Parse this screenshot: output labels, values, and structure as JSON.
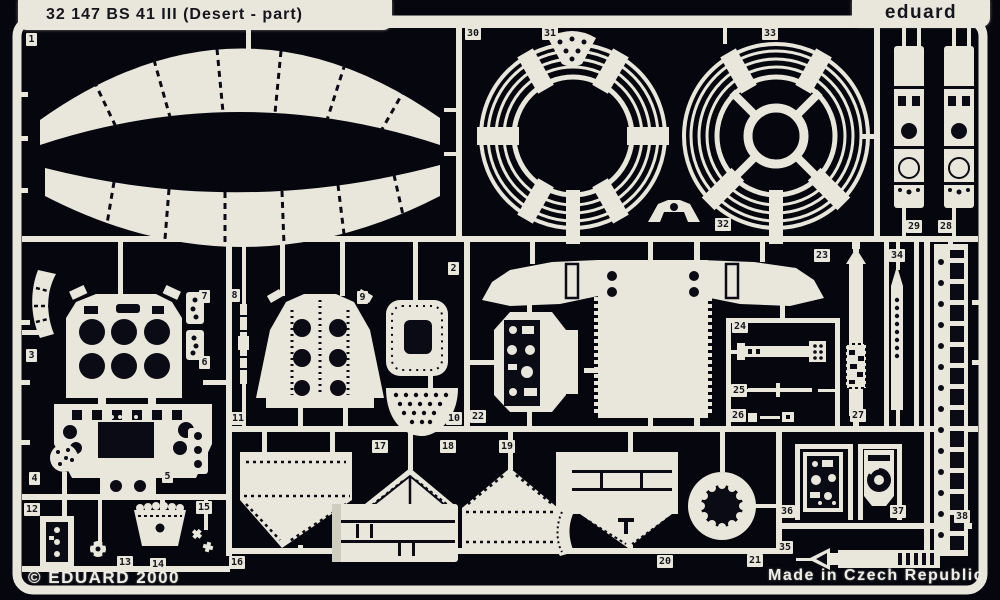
{
  "colors": {
    "background": "#06060e",
    "ink": "#0b0b16",
    "metal": "#e9e7dc",
    "metal_dim": "#cfccc0",
    "text_dark": "#15151d",
    "text_light": "#eeede6"
  },
  "header": {
    "title": "32 147 BS 41 III (Desert - part)",
    "brand": "eduard"
  },
  "footer": {
    "copyright": "© EDUARD 2000",
    "origin": "Made in Czech Republic"
  },
  "parts": [
    {
      "num": "1",
      "x": 26,
      "y": 33
    },
    {
      "num": "2",
      "x": 448,
      "y": 262
    },
    {
      "num": "3",
      "x": 26,
      "y": 349
    },
    {
      "num": "4",
      "x": 29,
      "y": 472
    },
    {
      "num": "5",
      "x": 162,
      "y": 470
    },
    {
      "num": "6",
      "x": 199,
      "y": 356
    },
    {
      "num": "7",
      "x": 199,
      "y": 290
    },
    {
      "num": "8",
      "x": 229,
      "y": 289
    },
    {
      "num": "9",
      "x": 357,
      "y": 291
    },
    {
      "num": "10",
      "x": 446,
      "y": 412
    },
    {
      "num": "11",
      "x": 230,
      "y": 412
    },
    {
      "num": "12",
      "x": 24,
      "y": 503
    },
    {
      "num": "13",
      "x": 117,
      "y": 556
    },
    {
      "num": "14",
      "x": 150,
      "y": 558
    },
    {
      "num": "15",
      "x": 196,
      "y": 501
    },
    {
      "num": "16",
      "x": 229,
      "y": 556
    },
    {
      "num": "17",
      "x": 372,
      "y": 440
    },
    {
      "num": "18",
      "x": 440,
      "y": 440
    },
    {
      "num": "19",
      "x": 499,
      "y": 440
    },
    {
      "num": "20",
      "x": 657,
      "y": 555
    },
    {
      "num": "21",
      "x": 747,
      "y": 554
    },
    {
      "num": "22",
      "x": 470,
      "y": 410
    },
    {
      "num": "23",
      "x": 814,
      "y": 249
    },
    {
      "num": "24",
      "x": 732,
      "y": 320
    },
    {
      "num": "25",
      "x": 731,
      "y": 384
    },
    {
      "num": "26",
      "x": 730,
      "y": 409
    },
    {
      "num": "27",
      "x": 850,
      "y": 409
    },
    {
      "num": "28",
      "x": 938,
      "y": 220
    },
    {
      "num": "29",
      "x": 906,
      "y": 220
    },
    {
      "num": "30",
      "x": 465,
      "y": 27
    },
    {
      "num": "31",
      "x": 542,
      "y": 27
    },
    {
      "num": "32",
      "x": 715,
      "y": 218
    },
    {
      "num": "33",
      "x": 762,
      "y": 27
    },
    {
      "num": "34",
      "x": 889,
      "y": 249
    },
    {
      "num": "35",
      "x": 777,
      "y": 541
    },
    {
      "num": "36",
      "x": 779,
      "y": 505
    },
    {
      "num": "37",
      "x": 890,
      "y": 505
    },
    {
      "num": "38",
      "x": 954,
      "y": 510
    }
  ]
}
